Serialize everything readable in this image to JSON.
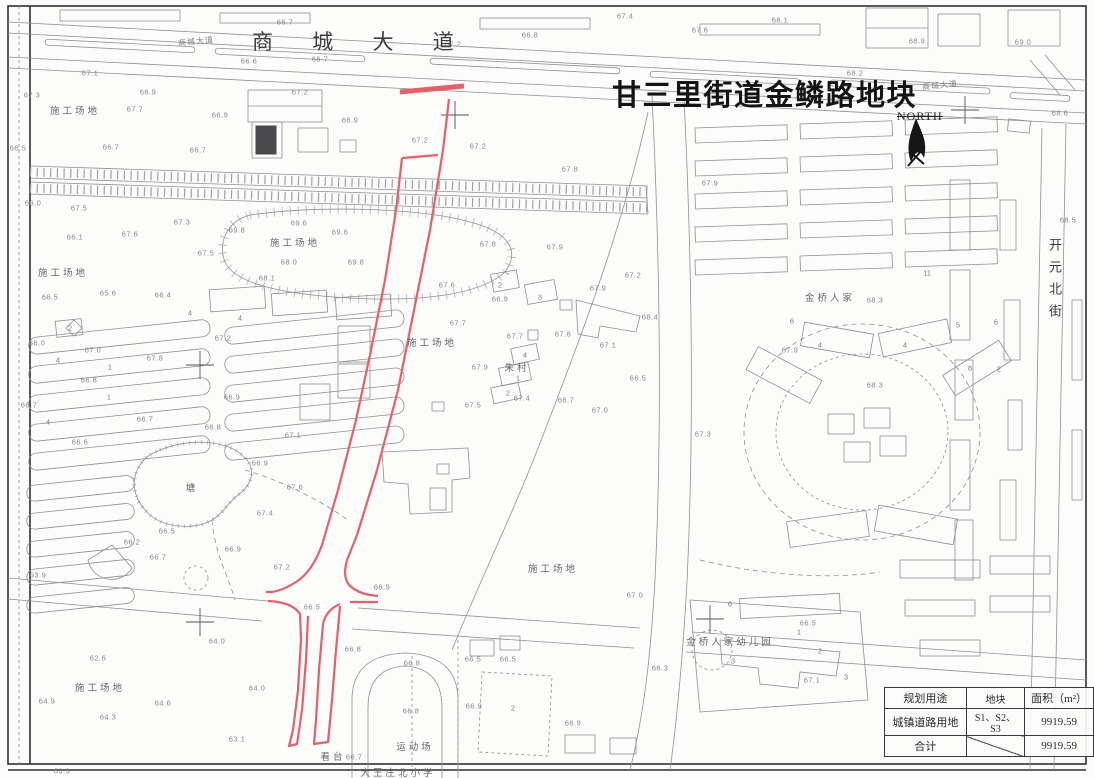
{
  "title": "甘三里街道金鳞路地块",
  "north": {
    "label": "NORTH"
  },
  "streets": {
    "top_avenue": "商 城 大 道",
    "top_avenue_small": "商城大道",
    "right_street_vertical": "开元北街"
  },
  "site_labels": [
    {
      "x": 75,
      "y": 110,
      "t": "施工场地"
    },
    {
      "x": 63,
      "y": 272,
      "t": "施工场地"
    },
    {
      "x": 295,
      "y": 242,
      "t": "施工场地"
    },
    {
      "x": 432,
      "y": 342,
      "t": "施工场地"
    },
    {
      "x": 553,
      "y": 568,
      "t": "施工场地"
    },
    {
      "x": 100,
      "y": 687,
      "t": "施工场地"
    },
    {
      "x": 192,
      "y": 487,
      "t": "塘"
    },
    {
      "x": 517,
      "y": 367,
      "t": "朱村"
    },
    {
      "x": 830,
      "y": 297,
      "t": "金桥人家"
    },
    {
      "x": 730,
      "y": 641,
      "t": "金桥人家幼儿园"
    },
    {
      "x": 415,
      "y": 746,
      "t": "运动场"
    },
    {
      "x": 333,
      "y": 756,
      "t": "看台"
    },
    {
      "x": 398,
      "y": 772,
      "t": "大王庄北小学"
    }
  ],
  "building_numbers": [
    {
      "x": 927,
      "y": 273,
      "t": "11"
    },
    {
      "x": 820,
      "y": 345,
      "t": "4"
    },
    {
      "x": 905,
      "y": 345,
      "t": "4"
    },
    {
      "x": 792,
      "y": 321,
      "t": "6"
    },
    {
      "x": 958,
      "y": 325,
      "t": "5"
    },
    {
      "x": 996,
      "y": 322,
      "t": "6"
    },
    {
      "x": 999,
      "y": 369,
      "t": "2"
    },
    {
      "x": 970,
      "y": 368,
      "t": "8"
    },
    {
      "x": 730,
      "y": 604,
      "t": "6"
    },
    {
      "x": 733,
      "y": 661,
      "t": "3"
    },
    {
      "x": 820,
      "y": 651,
      "t": "2"
    },
    {
      "x": 846,
      "y": 677,
      "t": "3"
    },
    {
      "x": 799,
      "y": 632,
      "t": "1"
    },
    {
      "x": 58,
      "y": 360,
      "t": "4"
    },
    {
      "x": 110,
      "y": 367,
      "t": "1"
    },
    {
      "x": 48,
      "y": 422,
      "t": "4"
    },
    {
      "x": 109,
      "y": 397,
      "t": "1"
    },
    {
      "x": 190,
      "y": 313,
      "t": "4"
    },
    {
      "x": 240,
      "y": 318,
      "t": "4"
    },
    {
      "x": 513,
      "y": 708,
      "t": "2"
    },
    {
      "x": 70,
      "y": 328,
      "t": "2"
    },
    {
      "x": 500,
      "y": 285,
      "t": "2"
    },
    {
      "x": 540,
      "y": 297,
      "t": "3"
    },
    {
      "x": 525,
      "y": 355,
      "t": "4"
    },
    {
      "x": 518,
      "y": 378,
      "t": "1"
    },
    {
      "x": 508,
      "y": 393,
      "t": "2"
    }
  ],
  "elevations": [
    {
      "x": 285,
      "y": 22,
      "v": "66.7"
    },
    {
      "x": 249,
      "y": 61,
      "v": "66.6"
    },
    {
      "x": 320,
      "y": 59,
      "v": "66.7"
    },
    {
      "x": 453,
      "y": 44,
      "v": "67.2"
    },
    {
      "x": 625,
      "y": 16,
      "v": "67.4"
    },
    {
      "x": 530,
      "y": 35,
      "v": "66.8"
    },
    {
      "x": 700,
      "y": 30,
      "v": "67.6"
    },
    {
      "x": 780,
      "y": 20,
      "v": "68.1"
    },
    {
      "x": 917,
      "y": 41,
      "v": "68.9"
    },
    {
      "x": 1023,
      "y": 42,
      "v": "69.0"
    },
    {
      "x": 855,
      "y": 73,
      "v": "68.2"
    },
    {
      "x": 1060,
      "y": 113,
      "v": "68.6"
    },
    {
      "x": 1068,
      "y": 220,
      "v": "68.5"
    },
    {
      "x": 32,
      "y": 95,
      "v": "67.3"
    },
    {
      "x": 90,
      "y": 73,
      "v": "67.1"
    },
    {
      "x": 135,
      "y": 109,
      "v": "67.7"
    },
    {
      "x": 220,
      "y": 115,
      "v": "66.9"
    },
    {
      "x": 300,
      "y": 92,
      "v": "67.2"
    },
    {
      "x": 350,
      "y": 120,
      "v": "66.9"
    },
    {
      "x": 18,
      "y": 148,
      "v": "66.5"
    },
    {
      "x": 111,
      "y": 147,
      "v": "66.7"
    },
    {
      "x": 198,
      "y": 150,
      "v": "66.7"
    },
    {
      "x": 420,
      "y": 140,
      "v": "67.2"
    },
    {
      "x": 478,
      "y": 146,
      "v": "67.2"
    },
    {
      "x": 33,
      "y": 203,
      "v": "66.0"
    },
    {
      "x": 79,
      "y": 208,
      "v": "67.5"
    },
    {
      "x": 75,
      "y": 237,
      "v": "66.1"
    },
    {
      "x": 130,
      "y": 234,
      "v": "67.6"
    },
    {
      "x": 182,
      "y": 222,
      "v": "67.3"
    },
    {
      "x": 206,
      "y": 253,
      "v": "67.5"
    },
    {
      "x": 237,
      "y": 230,
      "v": "69.8"
    },
    {
      "x": 299,
      "y": 223,
      "v": "69.6"
    },
    {
      "x": 340,
      "y": 232,
      "v": "69.6"
    },
    {
      "x": 356,
      "y": 262,
      "v": "69.8"
    },
    {
      "x": 289,
      "y": 262,
      "v": "68.0"
    },
    {
      "x": 267,
      "y": 278,
      "v": "68.1"
    },
    {
      "x": 570,
      "y": 169,
      "v": "67.8"
    },
    {
      "x": 710,
      "y": 183,
      "v": "67.9"
    },
    {
      "x": 488,
      "y": 244,
      "v": "67.8"
    },
    {
      "x": 555,
      "y": 247,
      "v": "67.9"
    },
    {
      "x": 447,
      "y": 285,
      "v": "67.6"
    },
    {
      "x": 500,
      "y": 299,
      "v": "66.9"
    },
    {
      "x": 598,
      "y": 288,
      "v": "67.9"
    },
    {
      "x": 633,
      "y": 275,
      "v": "67.2"
    },
    {
      "x": 650,
      "y": 317,
      "v": "68.4"
    },
    {
      "x": 458,
      "y": 323,
      "v": "67.7"
    },
    {
      "x": 515,
      "y": 336,
      "v": "67.7"
    },
    {
      "x": 563,
      "y": 334,
      "v": "67.6"
    },
    {
      "x": 608,
      "y": 345,
      "v": "67.1"
    },
    {
      "x": 480,
      "y": 367,
      "v": "67.9"
    },
    {
      "x": 522,
      "y": 398,
      "v": "67.4"
    },
    {
      "x": 566,
      "y": 400,
      "v": "66.7"
    },
    {
      "x": 473,
      "y": 405,
      "v": "67.5"
    },
    {
      "x": 638,
      "y": 378,
      "v": "66.5"
    },
    {
      "x": 600,
      "y": 410,
      "v": "67.0"
    },
    {
      "x": 50,
      "y": 297,
      "v": "66.5"
    },
    {
      "x": 108,
      "y": 293,
      "v": "65.6"
    },
    {
      "x": 163,
      "y": 295,
      "v": "66.4"
    },
    {
      "x": 37,
      "y": 343,
      "v": "66.0"
    },
    {
      "x": 93,
      "y": 350,
      "v": "67.0"
    },
    {
      "x": 223,
      "y": 338,
      "v": "67.2"
    },
    {
      "x": 155,
      "y": 358,
      "v": "67.8"
    },
    {
      "x": 89,
      "y": 380,
      "v": "66.8"
    },
    {
      "x": 29,
      "y": 405,
      "v": "66.7"
    },
    {
      "x": 232,
      "y": 397,
      "v": "66.9"
    },
    {
      "x": 145,
      "y": 419,
      "v": "66.7"
    },
    {
      "x": 213,
      "y": 427,
      "v": "66.8"
    },
    {
      "x": 80,
      "y": 442,
      "v": "66.6"
    },
    {
      "x": 293,
      "y": 435,
      "v": "67.1"
    },
    {
      "x": 260,
      "y": 463,
      "v": "66.9"
    },
    {
      "x": 295,
      "y": 487,
      "v": "67.6"
    },
    {
      "x": 265,
      "y": 513,
      "v": "67.4"
    },
    {
      "x": 167,
      "y": 531,
      "v": "66.5"
    },
    {
      "x": 132,
      "y": 542,
      "v": "66.2"
    },
    {
      "x": 158,
      "y": 557,
      "v": "66.7"
    },
    {
      "x": 233,
      "y": 549,
      "v": "66.9"
    },
    {
      "x": 282,
      "y": 567,
      "v": "67.2"
    },
    {
      "x": 98,
      "y": 658,
      "v": "62.6"
    },
    {
      "x": 47,
      "y": 701,
      "v": "64.9"
    },
    {
      "x": 217,
      "y": 641,
      "v": "64.0"
    },
    {
      "x": 257,
      "y": 688,
      "v": "64.0"
    },
    {
      "x": 163,
      "y": 703,
      "v": "64.6"
    },
    {
      "x": 108,
      "y": 717,
      "v": "64.3"
    },
    {
      "x": 237,
      "y": 739,
      "v": "63.1"
    },
    {
      "x": 62,
      "y": 771,
      "v": "63.3"
    },
    {
      "x": 38,
      "y": 575,
      "v": "63.9"
    },
    {
      "x": 382,
      "y": 587,
      "v": "66.9"
    },
    {
      "x": 312,
      "y": 607,
      "v": "66.5"
    },
    {
      "x": 353,
      "y": 649,
      "v": "66.8"
    },
    {
      "x": 412,
      "y": 663,
      "v": "66.8"
    },
    {
      "x": 473,
      "y": 659,
      "v": "66.5"
    },
    {
      "x": 508,
      "y": 659,
      "v": "66.5"
    },
    {
      "x": 411,
      "y": 711,
      "v": "66.8"
    },
    {
      "x": 474,
      "y": 706,
      "v": "66.9"
    },
    {
      "x": 354,
      "y": 757,
      "v": "66.7"
    },
    {
      "x": 635,
      "y": 595,
      "v": "67.0"
    },
    {
      "x": 808,
      "y": 623,
      "v": "66.5"
    },
    {
      "x": 660,
      "y": 668,
      "v": "66.3"
    },
    {
      "x": 812,
      "y": 680,
      "v": "67.1"
    },
    {
      "x": 790,
      "y": 350,
      "v": "67.9"
    },
    {
      "x": 875,
      "y": 300,
      "v": "68.3"
    },
    {
      "x": 875,
      "y": 385,
      "v": "68.3"
    },
    {
      "x": 703,
      "y": 434,
      "v": "67.3"
    },
    {
      "x": 148,
      "y": 92,
      "v": "66.9"
    },
    {
      "x": 573,
      "y": 723,
      "v": "66.9"
    }
  ],
  "table": {
    "headers": [
      "规划用途",
      "地块",
      "面积（m²）"
    ],
    "rows": [
      [
        "城镇道路用地",
        "S1、S2、S3",
        "9919.59"
      ],
      [
        "合计",
        "",
        "9919.59"
      ]
    ]
  },
  "colors": {
    "parcel_outline": "#e4606c",
    "linework": "#909095",
    "frame": "#2f2f33"
  }
}
